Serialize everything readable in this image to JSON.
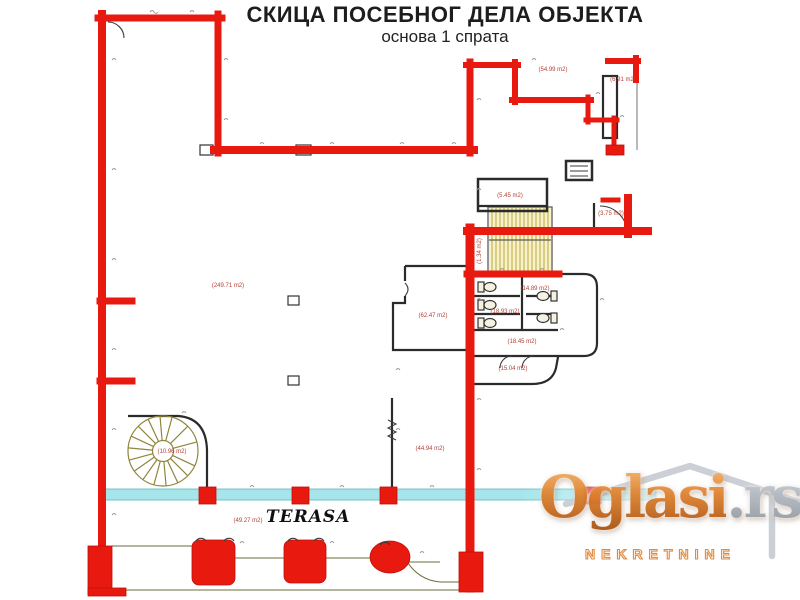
{
  "title": "СКИЦА ПОСЕБНОГ ДЕЛА ОБЈЕКТА",
  "subtitle": "основа  1 спрата",
  "plan": {
    "terrace_label": "TERASA",
    "rooms": [
      {
        "id": "main-hall",
        "area": "(249.71 m2)"
      },
      {
        "id": "top-right-room",
        "area": "(54.99 m2)"
      },
      {
        "id": "top-right-small",
        "area": "(6.91 m2)"
      },
      {
        "id": "storage-room",
        "area": "(5.45 m2)"
      },
      {
        "id": "wc-small",
        "area": "(3.75 m2)"
      },
      {
        "id": "stair-landing",
        "area": "(1.34 m2)"
      },
      {
        "id": "toilet-left",
        "area": "(18.93 m2)"
      },
      {
        "id": "toilet-right",
        "area": "(14.89 m2)"
      },
      {
        "id": "anteroom",
        "area": "(18.45 m2)"
      },
      {
        "id": "lower-hall",
        "area": "(15.04 m2)"
      },
      {
        "id": "office-upper",
        "area": "(62.47 m2)"
      },
      {
        "id": "office-lower",
        "area": "(44.94 m2)"
      },
      {
        "id": "spiral-stair",
        "area": "(10.96 m2)"
      },
      {
        "id": "terrace",
        "area": "(49.27 m2)"
      }
    ]
  },
  "watermark": {
    "brand": "Oglasi",
    "tld": ".rs",
    "tagline": "NEKRETNINE"
  },
  "colors": {
    "wall_red": "#e8190f",
    "glass_cyan": "#a6e6ea",
    "stair_yellow": "#b0a028",
    "spiral_olive": "#8f863c",
    "label_red": "#b24038",
    "watermark_orange": "#e08432"
  }
}
